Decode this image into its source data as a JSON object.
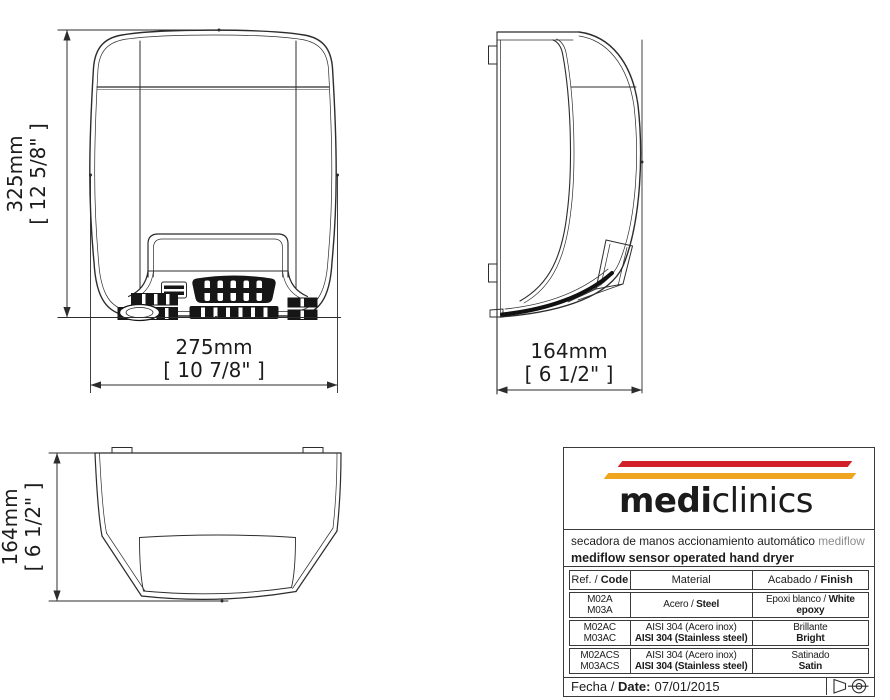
{
  "document": {
    "type": "technical drawing sheet",
    "product": "mediflow sensor operated hand dryer"
  },
  "dims": {
    "front_h_mm": "325mm",
    "front_h_in": "[ 12 5/8\" ]",
    "front_w_mm": "275mm",
    "front_w_in": "[ 10 7/8\" ]",
    "side_d_mm": "164mm",
    "side_d_in": "[ 6 1/2\" ]",
    "top_d_mm": "164mm",
    "top_d_in": "[ 6 1/2\" ]"
  },
  "tb": {
    "logo_bold": "medi",
    "logo_light": "clinics",
    "colors": {
      "stripe_red": "#d0202a",
      "stripe_yellow": "#efa51d",
      "logo_text": "#1b1b1b",
      "muted_gray": "#8c8c8c"
    },
    "sub_es": "secadora de manos accionamiento automático",
    "sub_es_product": "mediflow",
    "sub_en": "mediflow sensor operated hand dryer",
    "header": {
      "c1n": "Ref. / ",
      "c1b": "Code",
      "c2": "Material",
      "c3n": "Acabado / ",
      "c3b": "Finish"
    },
    "rows": [
      {
        "code1": "M02A",
        "code2": "M03A",
        "mat_n": "Acero / ",
        "mat_b": "Steel",
        "fin_n": "Epoxi blanco / ",
        "fin_b": "White epoxy"
      },
      {
        "code1": "M02AC",
        "code2": "M03AC",
        "mat1": "AISI 304 (Acero inox)",
        "mat2": "AISI 304 (Stainless steel)",
        "fin1": "Brillante",
        "fin2": "Bright"
      },
      {
        "code1": "M02ACS",
        "code2": "M03ACS",
        "mat1": "AISI 304 (Acero inox)",
        "mat2": "AISI 304 (Stainless steel)",
        "fin1": "Satinado",
        "fin2": "Satin"
      }
    ],
    "footer_label": "Fecha / ",
    "footer_label_bold": "Date:",
    "footer_value": "07/01/2015"
  }
}
